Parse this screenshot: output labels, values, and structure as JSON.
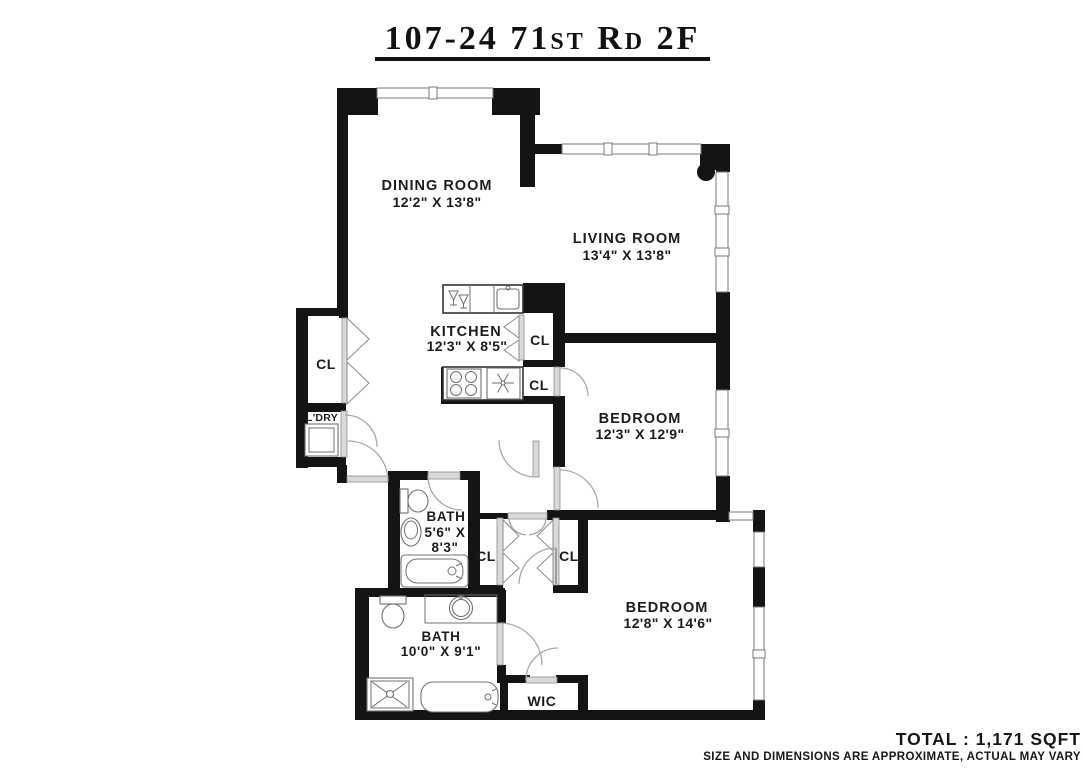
{
  "title": "107-24 71st Rd 2F",
  "plan": {
    "rooms": {
      "dining": {
        "name": "DINING ROOM",
        "dims": "12'2\" X 13'8\""
      },
      "living": {
        "name": "LIVING ROOM",
        "dims": "13'4\" X 13'8\""
      },
      "kitchen": {
        "name": "KITCHEN",
        "dims": "12'3\" X 8'5\""
      },
      "bedroom1": {
        "name": "BEDROOM",
        "dims": "12'3\" X 12'9\""
      },
      "bedroom2": {
        "name": "BEDROOM",
        "dims": "12'8\" X 14'6\""
      },
      "bath1": {
        "name": "BATH",
        "dims_line1": "5'6\" X",
        "dims_line2": "8'3\""
      },
      "bath2": {
        "name": "BATH",
        "dims": "10'0\" X 9'1\""
      },
      "laundry": {
        "name": "L'DRY"
      },
      "wic": {
        "name": "WIC"
      }
    },
    "closets": {
      "entry": "CL",
      "kitchen_upper": "CL",
      "kitchen_lower": "CL",
      "hall_left": "CL",
      "hall_right": "CL"
    }
  },
  "footer": {
    "total": "TOTAL : 1,171 SQFT",
    "disclaimer": "SIZE AND DIMENSIONS ARE APPROXIMATE, ACTUAL MAY VARY"
  },
  "colors": {
    "wall": "#141414",
    "door_line": "#a8a8a8",
    "fixture_line": "#707070",
    "background": "#ffffff"
  }
}
